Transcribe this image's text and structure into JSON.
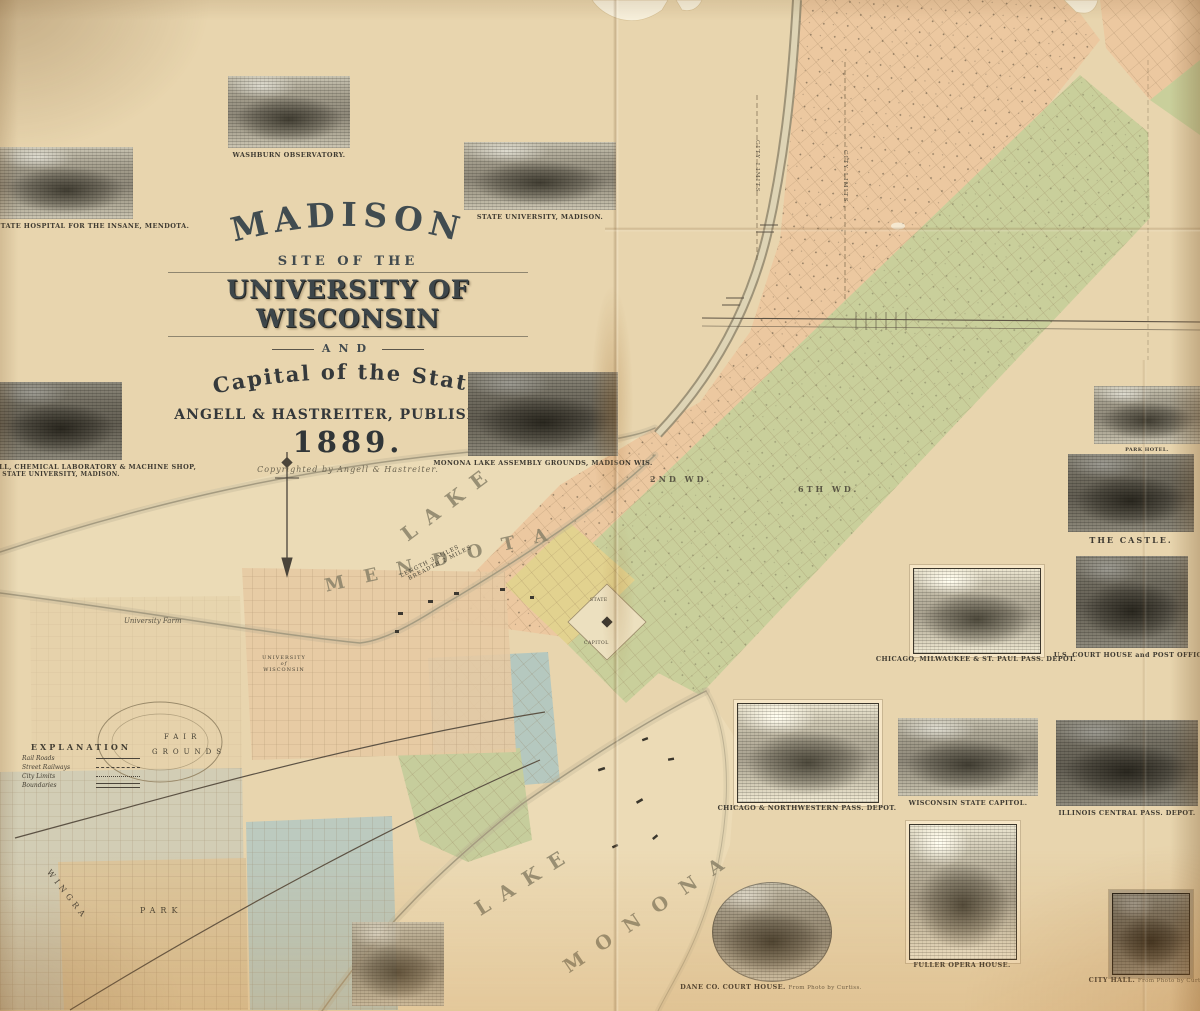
{
  "title": {
    "main": "MADISON",
    "line2": "SITE OF THE",
    "line3": "UNIVERSITY OF WISCONSIN",
    "line4": "AND",
    "line5": "Capital of the State",
    "publisher": "ANGELL & HASTREITER, PUBLISHERS.",
    "year": "1889.",
    "copyright": "Copyrighted by Angell & Hastreiter."
  },
  "legend": {
    "title": "EXPLANATION",
    "items": [
      "Rail Roads",
      "Street Railways",
      "City Limits",
      "Boundaries"
    ]
  },
  "labels": {
    "lake_mendota_1": "LAKE",
    "lake_mendota_2": "MENDOTA",
    "lake_monona_1": "LAKE",
    "lake_monona_2": "MONONA",
    "university_1": "UNIVERSITY",
    "university_2": "of",
    "university_3": "WISCONSIN",
    "university_farm": "University Farm",
    "fair_grounds_1": "FAIR",
    "fair_grounds_2": "GROUNDS",
    "ward_2": "2ND WD.",
    "ward_6": "6TH WD.",
    "scale_1": "LENGTH 3 MILES",
    "scale_2": "BREADTH 2 MILES",
    "capitol_1": "STATE",
    "capitol_2": "CAPITOL",
    "city_limits_a": "CITY LIMITS",
    "city_limits_b": "CITY LIMITS",
    "wingra": "WINGRA",
    "park": "PARK"
  },
  "vignettes": [
    {
      "caption": "WISCONSIN STATE HOSPITAL FOR THE INSANE, MENDOTA."
    },
    {
      "caption": "WASHBURN OBSERVATORY."
    },
    {
      "caption": "STATE UNIVERSITY, MADISON."
    },
    {
      "caption": "NEW SCIENCE HALL, CHEMICAL LABORATORY & MACHINE SHOP,",
      "sub2": "STATE UNIVERSITY, MADISON."
    },
    {
      "caption": "MONONA LAKE ASSEMBLY GROUNDS, MADISON WIS."
    },
    {
      "caption": "PARK HOTEL."
    },
    {
      "caption": "THE CASTLE."
    },
    {
      "caption": "CHICAGO, MILWAUKEE & ST. PAUL PASS. DEPOT."
    },
    {
      "caption": "U.S. COURT HOUSE and POST OFFICE."
    },
    {
      "caption": "CHICAGO & NORTHWESTERN PASS. DEPOT."
    },
    {
      "caption": "WISCONSIN STATE CAPITOL."
    },
    {
      "caption": "ILLINOIS CENTRAL PASS. DEPOT."
    },
    {
      "caption": "DANE CO. COURT HOUSE.",
      "sub": "From Photo by Curtiss."
    },
    {
      "caption": "FULLER OPERA HOUSE."
    },
    {
      "caption": "CITY HALL.",
      "sub": "From Photo by Curtiss."
    }
  ],
  "colors": {
    "paper": "#e8d5ae",
    "ward_peach": "#ecc8a0",
    "ward_green": "#c9cf9b",
    "ward_yellow": "#e2d28f",
    "ward_teal": "#b5c8bf",
    "water": "#ecdcb8",
    "ink": "#454034"
  }
}
